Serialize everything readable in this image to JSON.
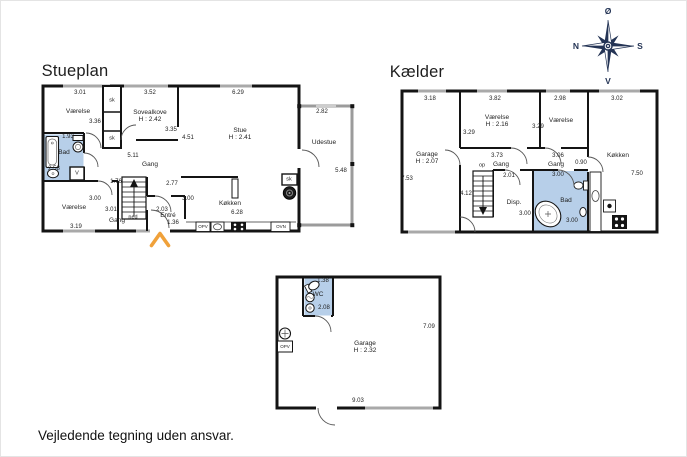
{
  "page": {
    "disclaimer": "Vejledende tegning uden ansvar."
  },
  "compass": {
    "top": "Ø",
    "left": "N",
    "right": "S",
    "bottom": "V"
  },
  "colors": {
    "wall": "#141414",
    "wet_room_fill": "#b7cfe9",
    "window": "#a9a9a9",
    "outdoor_wall": "#9b9b9b",
    "entry_arrow": "#f0a13a",
    "compass": "#243455"
  },
  "plans": [
    {
      "id": "stueplan",
      "title": "Stueplan",
      "title_xy": [
        75,
        71
      ],
      "labels": [
        {
          "t": "3.01",
          "x": 80,
          "y": 93,
          "c": "dim"
        },
        {
          "t": "3.52",
          "x": 150,
          "y": 93,
          "c": "dim"
        },
        {
          "t": "6.29",
          "x": 238,
          "y": 93,
          "c": "dim"
        },
        {
          "t": "2.82",
          "x": 322,
          "y": 112,
          "c": "dim"
        },
        {
          "t": "Værelse",
          "x": 78,
          "y": 112,
          "c": "room"
        },
        {
          "t": "sk",
          "x": 112,
          "y": 101,
          "c": "sm"
        },
        {
          "t": "sk",
          "x": 112,
          "y": 139,
          "c": "sm"
        },
        {
          "t": "Sovealkove",
          "x": 150,
          "y": 113,
          "c": "room"
        },
        {
          "t": "H : 2.42",
          "x": 150,
          "y": 120,
          "c": "room"
        },
        {
          "t": "3.36",
          "x": 95,
          "y": 122,
          "c": "dim"
        },
        {
          "t": "3.35",
          "x": 171,
          "y": 130,
          "c": "dim"
        },
        {
          "t": "4.51",
          "x": 188,
          "y": 138,
          "c": "dim"
        },
        {
          "t": "Stue",
          "x": 240,
          "y": 131,
          "c": "room"
        },
        {
          "t": "H : 2.41",
          "x": 240,
          "y": 138,
          "c": "room"
        },
        {
          "t": "Udestue",
          "x": 324,
          "y": 143,
          "c": "room"
        },
        {
          "t": "5.48",
          "x": 341,
          "y": 171,
          "c": "dim"
        },
        {
          "t": "1.93",
          "x": 68,
          "y": 137,
          "c": "dim"
        },
        {
          "t": "Bad",
          "x": 64,
          "y": 153,
          "c": "room"
        },
        {
          "t": "2.58",
          "x": 54,
          "y": 169,
          "c": "dim"
        },
        {
          "t": "V",
          "x": 77,
          "y": 174,
          "c": "sm"
        },
        {
          "t": "5.11",
          "x": 133,
          "y": 156,
          "c": "dim"
        },
        {
          "t": "Gang",
          "x": 150,
          "y": 165,
          "c": "room"
        },
        {
          "t": "1.76",
          "x": 116,
          "y": 182,
          "c": "dim"
        },
        {
          "t": "2.77",
          "x": 172,
          "y": 184,
          "c": "dim"
        },
        {
          "t": "3.00",
          "x": 188,
          "y": 199,
          "c": "dim"
        },
        {
          "t": "3.00",
          "x": 95,
          "y": 199,
          "c": "dim"
        },
        {
          "t": "Værelse",
          "x": 74,
          "y": 208,
          "c": "room"
        },
        {
          "t": "3.01",
          "x": 111,
          "y": 210,
          "c": "dim"
        },
        {
          "t": "Gang",
          "x": 117,
          "y": 221,
          "c": "room"
        },
        {
          "t": "ned",
          "x": 133,
          "y": 218,
          "c": "sm"
        },
        {
          "t": "3.19",
          "x": 76,
          "y": 227,
          "c": "dim"
        },
        {
          "t": "2.03",
          "x": 162,
          "y": 210,
          "c": "dim"
        },
        {
          "t": "Entré",
          "x": 168,
          "y": 216,
          "c": "room"
        },
        {
          "t": "1.36",
          "x": 173,
          "y": 223,
          "c": "dim"
        },
        {
          "t": "Køkken",
          "x": 230,
          "y": 204,
          "c": "room"
        },
        {
          "t": "6.28",
          "x": 237,
          "y": 213,
          "c": "dim"
        },
        {
          "t": "sk",
          "x": 289,
          "y": 180,
          "c": "sm"
        },
        {
          "t": "OPV",
          "x": 203,
          "y": 227,
          "c": "xs"
        },
        {
          "t": "OVN",
          "x": 281,
          "y": 227,
          "c": "xs"
        }
      ]
    },
    {
      "id": "kaelder",
      "title": "Kælder",
      "title_xy": [
        417,
        72
      ],
      "labels": [
        {
          "t": "3.18",
          "x": 430,
          "y": 99,
          "c": "dim"
        },
        {
          "t": "3.82",
          "x": 495,
          "y": 99,
          "c": "dim"
        },
        {
          "t": "2.98",
          "x": 560,
          "y": 99,
          "c": "dim"
        },
        {
          "t": "3.02",
          "x": 617,
          "y": 99,
          "c": "dim"
        },
        {
          "t": "Garage",
          "x": 427,
          "y": 155,
          "c": "room"
        },
        {
          "t": "H : 2.07",
          "x": 427,
          "y": 162,
          "c": "room"
        },
        {
          "t": "7.53",
          "x": 407,
          "y": 179,
          "c": "dim"
        },
        {
          "t": "Værelse",
          "x": 497,
          "y": 118,
          "c": "room"
        },
        {
          "t": "H : 2.16",
          "x": 497,
          "y": 125,
          "c": "room"
        },
        {
          "t": "3.29",
          "x": 469,
          "y": 133,
          "c": "dim"
        },
        {
          "t": "3.29",
          "x": 538,
          "y": 127,
          "c": "dim"
        },
        {
          "t": "Værelse",
          "x": 561,
          "y": 121,
          "c": "room"
        },
        {
          "t": "Køkken",
          "x": 618,
          "y": 156,
          "c": "room"
        },
        {
          "t": "7.50",
          "x": 637,
          "y": 174,
          "c": "dim"
        },
        {
          "t": "3.73",
          "x": 497,
          "y": 156,
          "c": "dim"
        },
        {
          "t": "op",
          "x": 482,
          "y": 166,
          "c": "sm"
        },
        {
          "t": "Gang",
          "x": 501,
          "y": 165,
          "c": "room"
        },
        {
          "t": "3.06",
          "x": 558,
          "y": 156,
          "c": "dim"
        },
        {
          "t": "Gang",
          "x": 556,
          "y": 165,
          "c": "room"
        },
        {
          "t": "0.90",
          "x": 581,
          "y": 163,
          "c": "dim"
        },
        {
          "t": "2.01",
          "x": 509,
          "y": 176,
          "c": "dim"
        },
        {
          "t": "4.12",
          "x": 466,
          "y": 194,
          "c": "dim"
        },
        {
          "t": "Disp.",
          "x": 514,
          "y": 203,
          "c": "room"
        },
        {
          "t": "3.00",
          "x": 525,
          "y": 214,
          "c": "dim"
        },
        {
          "t": "3.00",
          "x": 558,
          "y": 175,
          "c": "dim"
        },
        {
          "t": "Bad",
          "x": 566,
          "y": 201,
          "c": "room"
        },
        {
          "t": "3.00",
          "x": 572,
          "y": 221,
          "c": "dim"
        }
      ]
    },
    {
      "id": "garage",
      "title": "",
      "title_xy": [
        0,
        0
      ],
      "labels": [
        {
          "t": "1.38",
          "x": 323,
          "y": 281,
          "c": "dim"
        },
        {
          "t": "WC",
          "x": 318,
          "y": 295,
          "c": "room"
        },
        {
          "t": "2.08",
          "x": 324,
          "y": 308,
          "c": "dim"
        },
        {
          "t": "OPV",
          "x": 285,
          "y": 347,
          "c": "xs"
        },
        {
          "t": "Garage",
          "x": 365,
          "y": 344,
          "c": "room"
        },
        {
          "t": "H : 2.32",
          "x": 365,
          "y": 351,
          "c": "room"
        },
        {
          "t": "7.09",
          "x": 429,
          "y": 327,
          "c": "dim"
        },
        {
          "t": "9.03",
          "x": 358,
          "y": 401,
          "c": "dim"
        }
      ]
    }
  ]
}
